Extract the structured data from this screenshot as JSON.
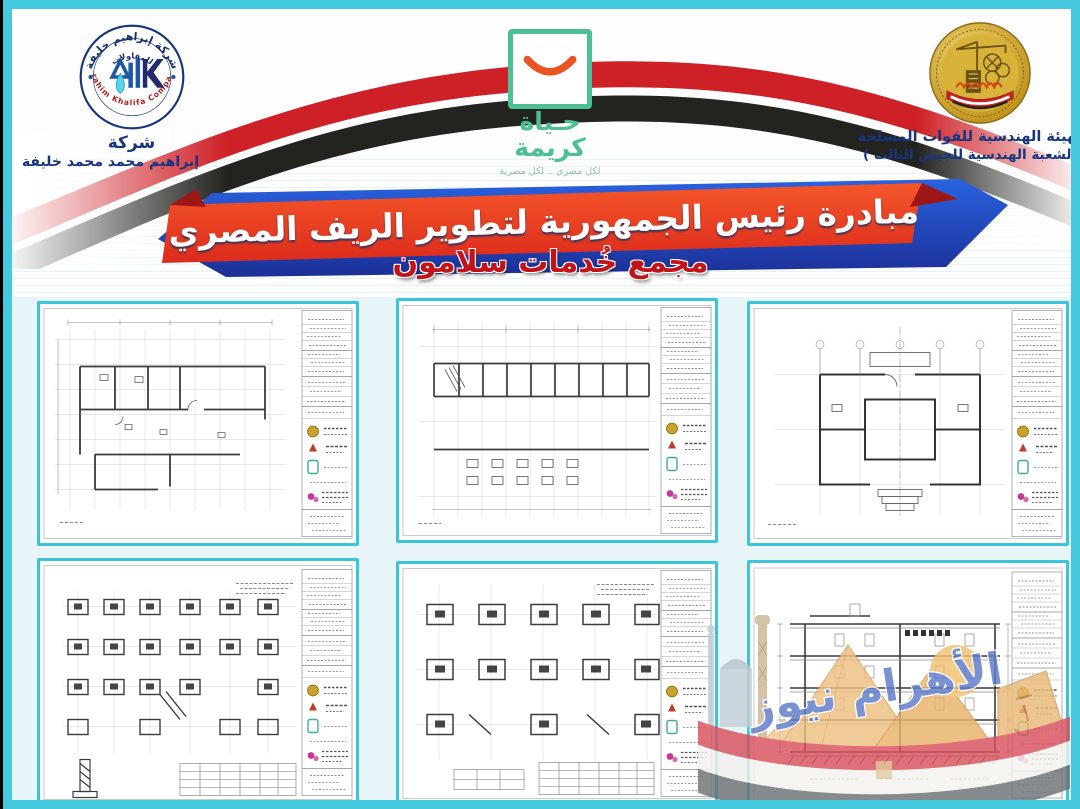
{
  "header": {
    "company_logo": {
      "arc_top": "شركة إبراهيم خليفة",
      "arc_mid": "للمقاولات",
      "arc_bottom": "Ibrahim Khalifa Company",
      "name_line1": "شركة",
      "name_line2": "إبراهيم محمد محمد خليفة"
    },
    "decent_life_logo": {
      "title_line1": "حـياة",
      "title_line2": "كريمة",
      "tagline": "لكل مصري .. لكل مصرية"
    },
    "engineering_authority": {
      "line1": "الهيئة الهندسية للقوات المسلحة",
      "line2": "( الشعبة الهندسية للجيش الثالث )"
    }
  },
  "banner": {
    "title": "مبادرة رئيس الجمهورية لتطوير الريف المصري",
    "subtitle": "مجمع خُدمات سلامون"
  },
  "watermark": {
    "text": "الأهرام نيوز"
  },
  "colors": {
    "frame_teal": "#45c9de",
    "flag_red": "#ce2127",
    "flag_black": "#232320",
    "banner_orange": "#ef4d23",
    "banner_blue": "#1f4ec4",
    "subtitle_red": "#c21418",
    "logo_green": "#4cbf93",
    "smile_orange": "#e95420",
    "gold": "#c9a227",
    "navy_text": "#16357e"
  }
}
